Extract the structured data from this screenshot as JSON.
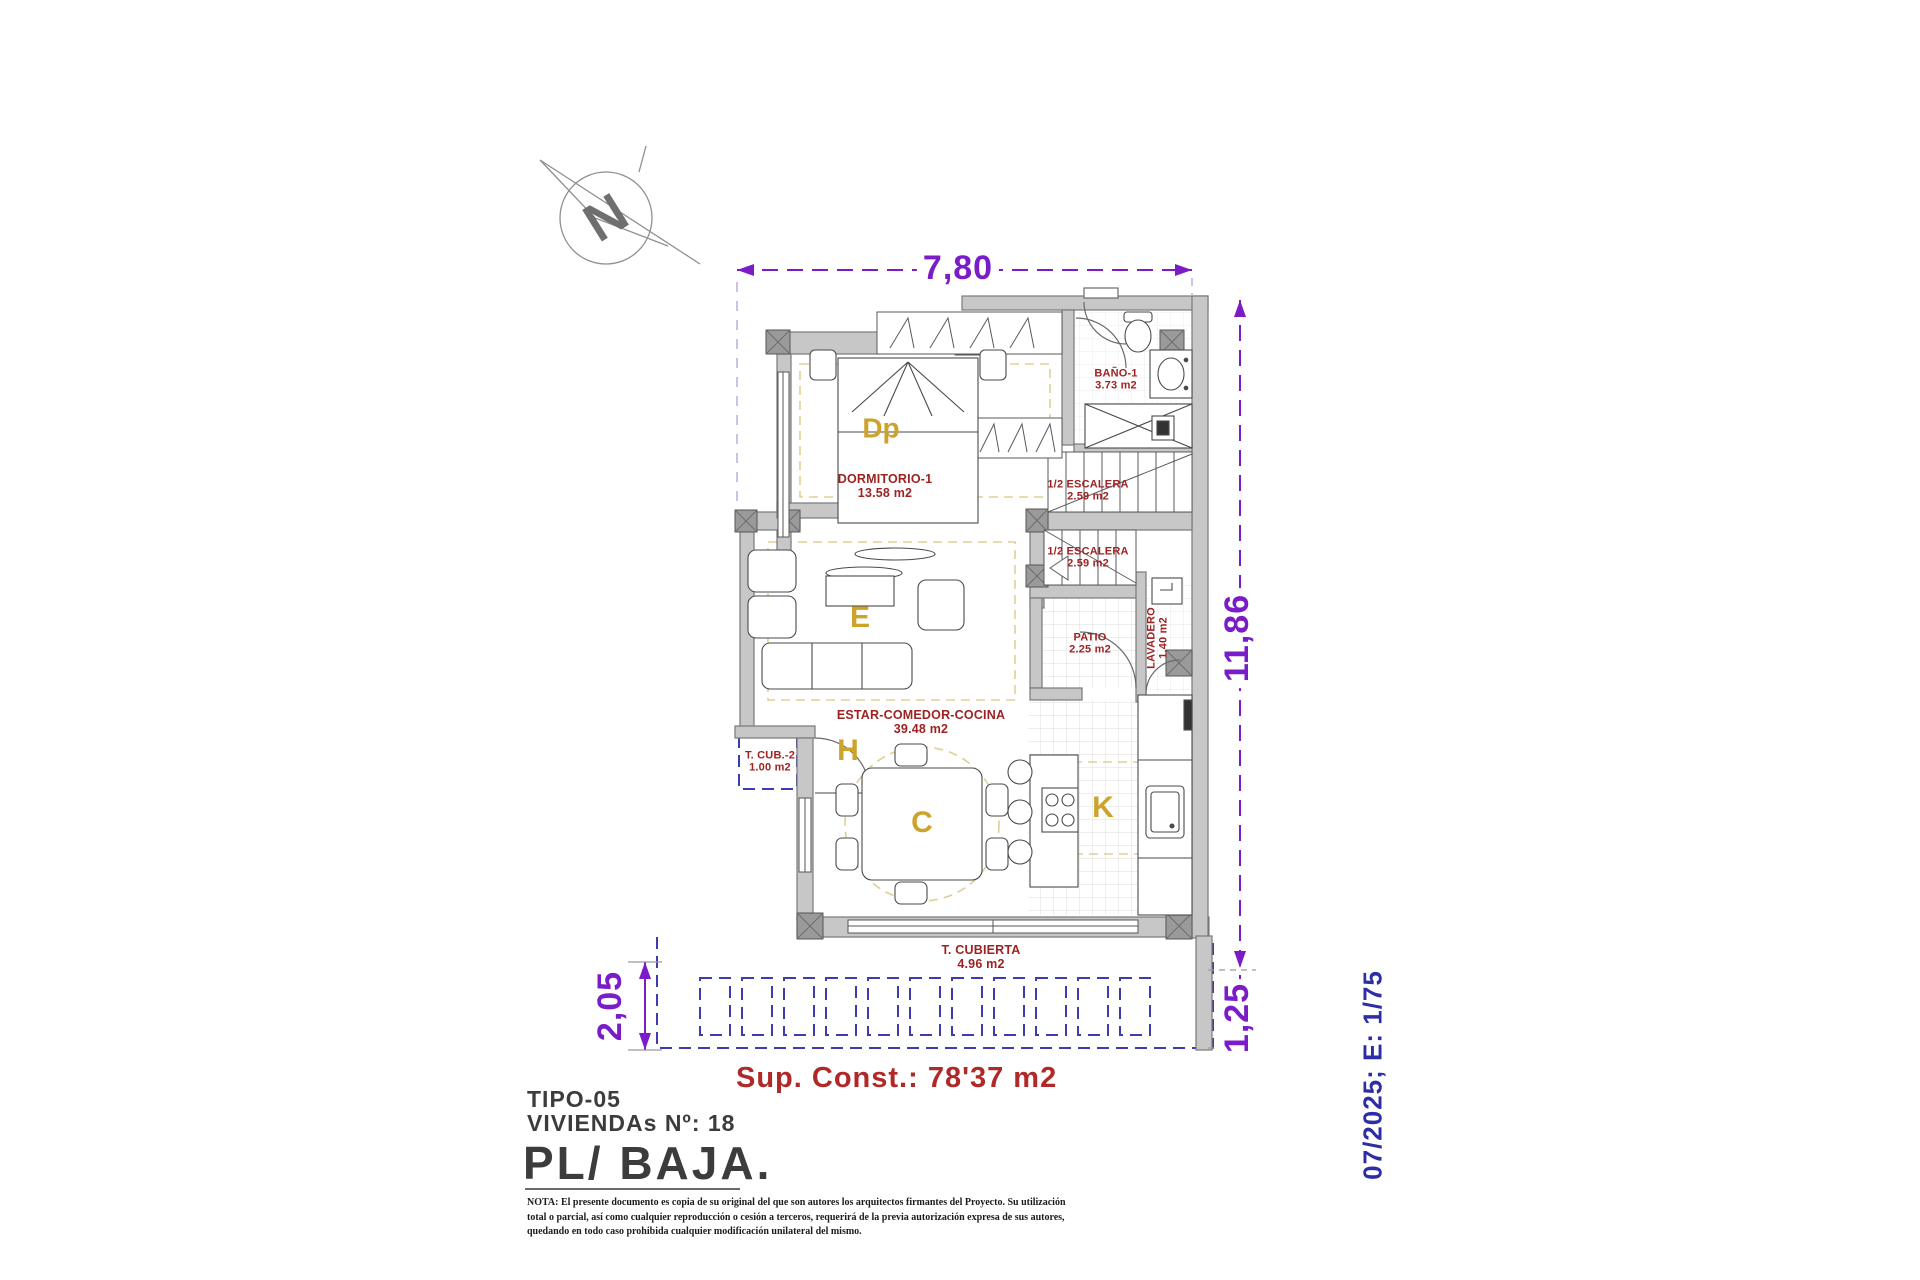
{
  "plan": {
    "north": "N",
    "dims": {
      "top": "7,80",
      "right": "11,86",
      "bottom_left": "2,05",
      "bottom_right": "1,25"
    },
    "sup_const": "Sup. Const.: 78'37 m2",
    "rooms": {
      "dormitorio": {
        "name": "DORMITORIO-1",
        "area": "13.58 m2",
        "letter": "Dp"
      },
      "bano": {
        "name": "BAÑO-1",
        "area": "3.73 m2"
      },
      "escalera_superior": {
        "name": "1/2 ESCALERA",
        "area": "2.59 m2"
      },
      "escalera_inferior": {
        "name": "1/2 ESCALERA",
        "area": "2.59 m2"
      },
      "patio": {
        "name": "PATIO",
        "area": "2.25 m2"
      },
      "lavadero": {
        "name": "LAVADERO",
        "area": "1.40 m2"
      },
      "estar": {
        "name": "ESTAR-COMEDOR-COCINA",
        "area": "39.48 m2",
        "letter_estar": "E",
        "letter_hall": "H",
        "letter_comedor": "C",
        "letter_cocina": "K"
      },
      "terraza_cubierta_2": {
        "name": "T. CUB.-2",
        "area": "1.00 m2"
      },
      "terraza_cubierta": {
        "name": "T. CUBIERTA",
        "area": "4.96 m2"
      }
    }
  },
  "title_block": {
    "tipo": "TIPO-05",
    "viviendas": "VIVIENDAs Nº: 18",
    "planta": "PL/ BAJA.",
    "nota": "NOTA: El presente documento es copia de su original del que son autores los arquitectos firmantes del Proyecto. Su utilización total o parcial, así como cualquier reproducción o cesión a terceros, requerirá  de la previa autorización expresa de sus autores, quedando en todo caso prohibida cualquier modificación unilateral del mismo."
  },
  "footer": {
    "date_scale": "07/2025; E: 1/75"
  },
  "colors": {
    "dimension_purple": "#7a1cc8",
    "label_red": "#9e2222",
    "zone_gold": "#cda32b",
    "pergola_blue": "#3c3cb0",
    "date_blue": "#2d2da6",
    "wall_gray": "#c7c7c7"
  }
}
